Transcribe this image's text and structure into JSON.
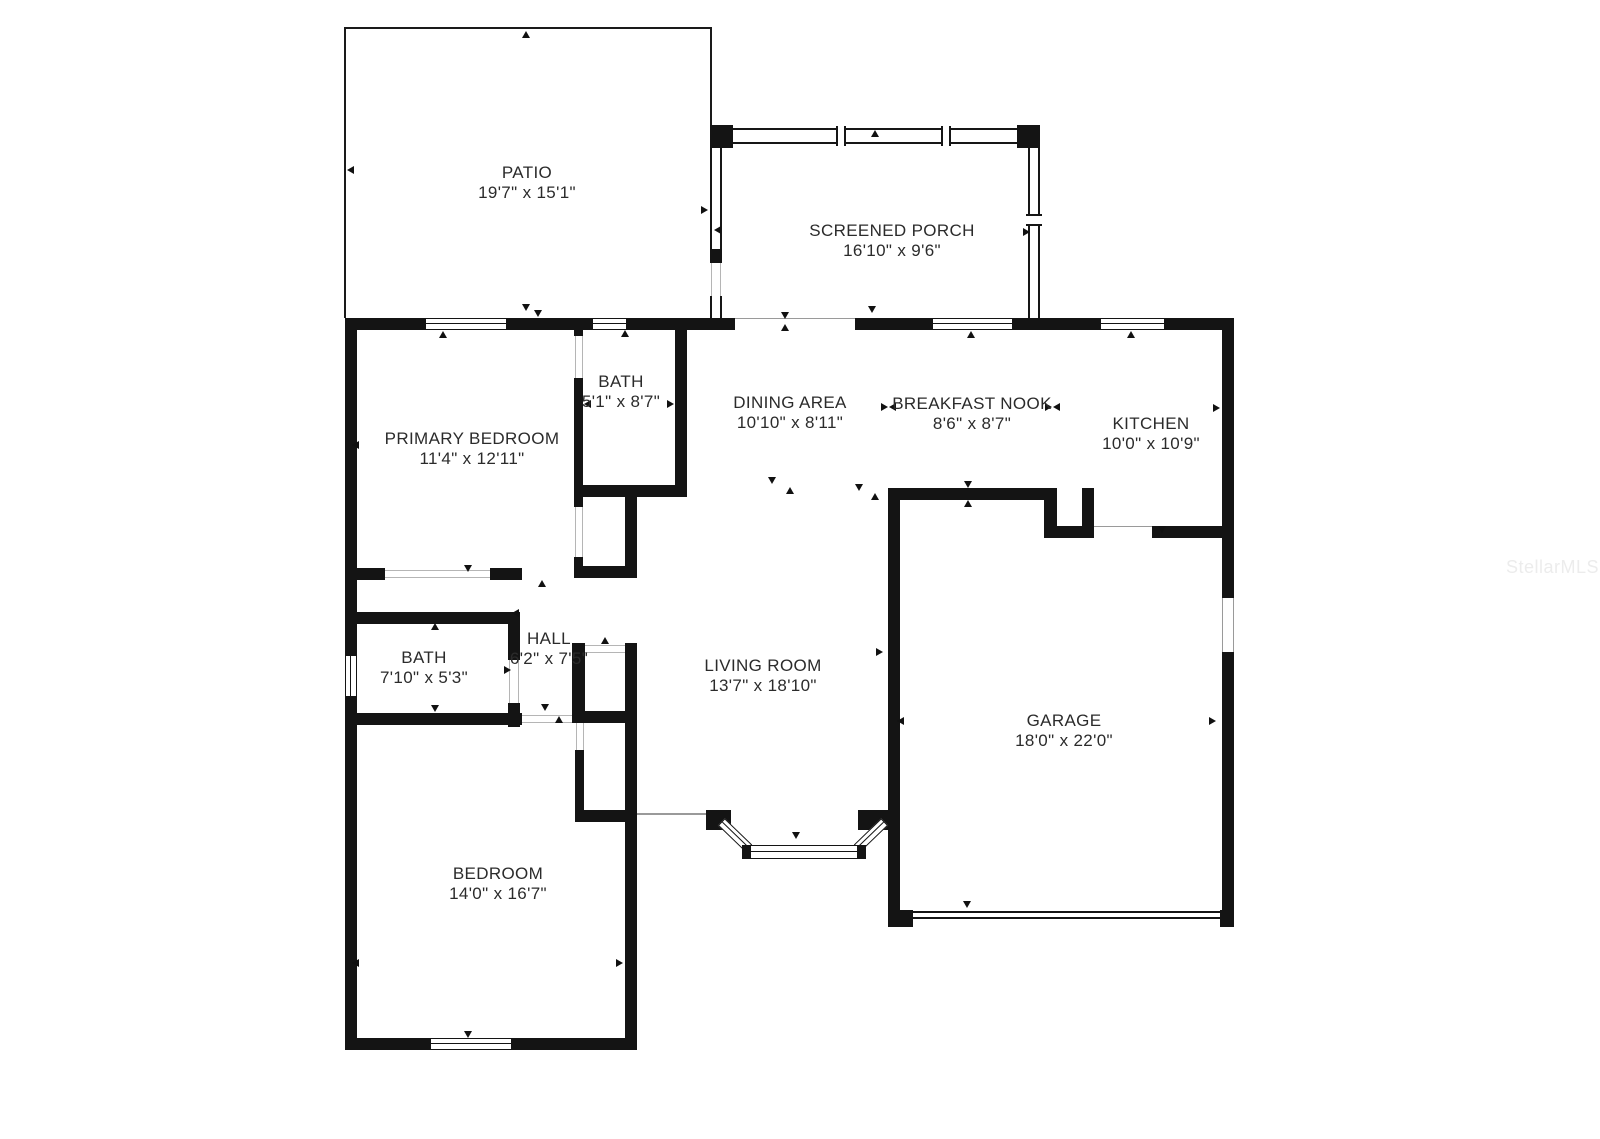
{
  "plan": {
    "watermark": "StellarMLS",
    "colors": {
      "wall": "#141414",
      "label": "#2b2b2b",
      "watermark": "#ececec"
    },
    "rooms": [
      {
        "id": "patio",
        "name": "PATIO",
        "dims": "19'7\" x 15'1\""
      },
      {
        "id": "screened-porch",
        "name": "SCREENED PORCH",
        "dims": "16'10\" x 9'6\""
      },
      {
        "id": "bath-ensuite",
        "name": "BATH",
        "dims": "5'1\" x 8'7\""
      },
      {
        "id": "dining-area",
        "name": "DINING AREA",
        "dims": "10'10\" x 8'11\""
      },
      {
        "id": "breakfast-nook",
        "name": "BREAKFAST NOOK",
        "dims": "8'6\" x 8'7\""
      },
      {
        "id": "kitchen",
        "name": "KITCHEN",
        "dims": "10'0\" x 10'9\""
      },
      {
        "id": "primary-bedroom",
        "name": "PRIMARY BEDROOM",
        "dims": "11'4\" x 12'11\""
      },
      {
        "id": "hall",
        "name": "HALL",
        "dims": "6'2\" x 7'5\""
      },
      {
        "id": "bath",
        "name": "BATH",
        "dims": "7'10\" x 5'3\""
      },
      {
        "id": "living-room",
        "name": "LIVING ROOM",
        "dims": "13'7\" x 18'10\""
      },
      {
        "id": "garage",
        "name": "GARAGE",
        "dims": "18'0\" x 22'0\""
      },
      {
        "id": "bedroom",
        "name": "BEDROOM",
        "dims": "14'0\" x 16'7\""
      }
    ]
  }
}
